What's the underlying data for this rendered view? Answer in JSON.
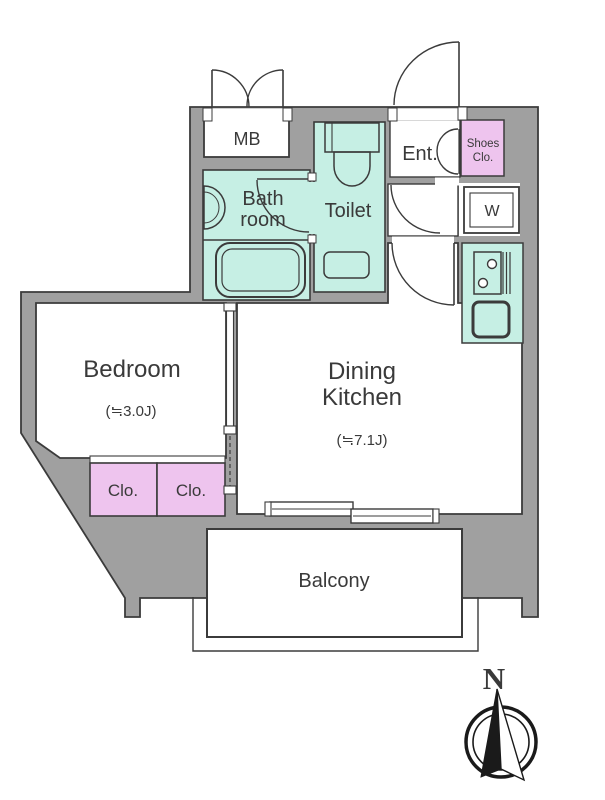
{
  "plan": {
    "rooms": {
      "mb": "MB",
      "bath_line1": "Bath",
      "bath_line2": "room",
      "toilet": "Toilet",
      "entrance": "Ent.",
      "shoes_line1": "Shoes",
      "shoes_line2": "Clo.",
      "washer": "W",
      "bedroom": "Bedroom",
      "bedroom_size": "(≒3.0J)",
      "dk_line1": "Dining",
      "dk_line2": "Kitchen",
      "dk_size": "(≒7.1J)",
      "closet_left": "Clo.",
      "closet_right": "Clo.",
      "balcony": "Balcony"
    },
    "compass": {
      "north_label": "N"
    },
    "colors": {
      "wall_gray": "#a0a0a0",
      "wet_area_teal": "#c6efe4",
      "closet_pink": "#eec4ee",
      "outline": "#3b3b3b"
    }
  }
}
